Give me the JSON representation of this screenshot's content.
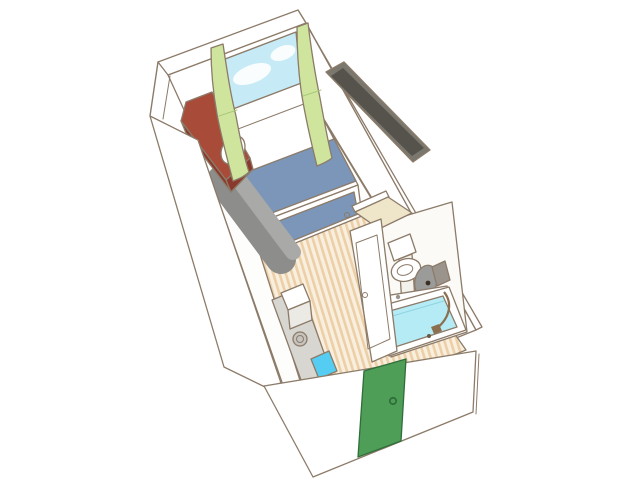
{
  "canvas": {
    "width": 640,
    "height": 480
  },
  "palette": {
    "background": "#ffffff",
    "ink": "#8c7b69",
    "ink_dark": "#6b5b4c",
    "wall_white": "#ffffff",
    "interior_white": "#fdfdfb",
    "sky": "#c7ebf6",
    "cloud": "#ffffff",
    "curtain_green": "#cfe59e",
    "curtain_green_dark": "#a9c878",
    "blanket_blue": "#7b96b8",
    "desk_red": "#a84b38",
    "desk_red_dark": "#8a3a2c",
    "sofa_dark": "#8d8d8b",
    "sofa_light": "#a9a9a7",
    "tv_frame": "#7a776e",
    "tv_screen": "#55534c",
    "floor_base": "#f9efdf",
    "floor_stripe": "#eccfa6",
    "platform_gray": "#d8d6d0",
    "box_front": "#eceae4",
    "kettle_body": "#c6c4be",
    "kettle_lid": "#efede8",
    "mat_blue": "#55cdf2",
    "bath_floor": "#fbfaf6",
    "top_beige": "#efe5c9",
    "toilet_lid_gray": "#9b9b99",
    "toilet_lid_dot": "#3a2f23",
    "toilet_bowl_inner": "#dceef0",
    "pedestal": "#f4f2ec",
    "mirror_gray": "#9a948c",
    "tub_water": "#b5ebf4",
    "water_line": "#8fd3e2",
    "drain_brown": "#6b5840",
    "hose_brown": "#8b6f4e",
    "door_green": "#4f9e58",
    "door_green_dark": "#2f6e3a",
    "knob_fill": "#dddbd5"
  }
}
